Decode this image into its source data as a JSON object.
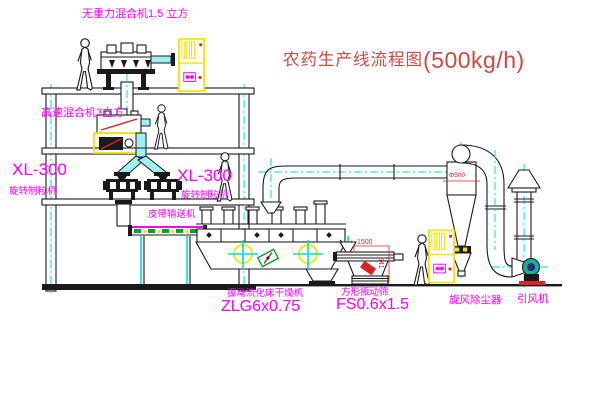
{
  "title": {
    "name": "农药生产线流程图",
    "capacity": "(500kg/h)"
  },
  "labels": {
    "top_mixer": "无重力混合机1.5 立方",
    "high_speed_mixer": "高速混合机3立方",
    "granulator_left_model": "XL-300",
    "granulator_left_name": "旋转制粒机",
    "granulator_center_model": "XL-300",
    "granulator_center_name": "旋转制粒机",
    "belt_conveyor": "皮带输送机",
    "fluid_bed_dryer_name": "振动流化床干燥机",
    "fluid_bed_dryer_model": "ZLG6x0.75",
    "vibrating_screen_name": "方形振动筛",
    "vibrating_screen_model": "FS0.6x1.5",
    "cyclone": "旋风除尘器",
    "induced_draft_fan": "引风机"
  },
  "dimensions": {
    "screen_length": "1500",
    "screen_height": "541",
    "cyclone_note": "Φ500"
  },
  "colors": {
    "label_magenta": "#ff00ff",
    "title_red": "#cd4a43",
    "centerline_cyan": "#00dcdc",
    "highlight_yellow": "#f2e300",
    "dim_red": "#dd2222",
    "conveyor_green": "#00a32e",
    "fan_teal": "#16b09a",
    "fan_hub_blue": "#1d2f9e"
  }
}
